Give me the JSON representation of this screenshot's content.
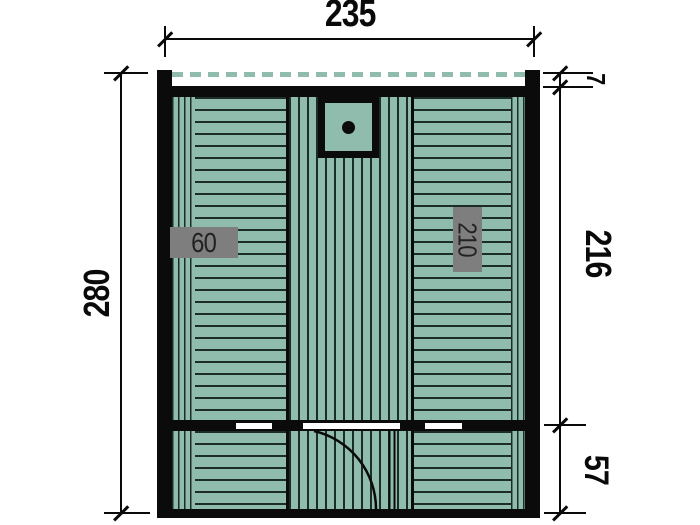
{
  "dims": {
    "width": "235",
    "height": "280",
    "overhang": "7",
    "main_depth": "216",
    "front_depth": "57"
  },
  "labels": {
    "bench_width": "60",
    "bench_length": "210"
  },
  "colors": {
    "bg": "#ffffff",
    "plank": "#8fbcad",
    "plank_line": "#1b2d26",
    "wall": "#0b0b0b",
    "dash": "#8fbcad",
    "dim": "#0a0a0a",
    "label_bg": "#7e7e7e",
    "label_text": "#222222"
  }
}
